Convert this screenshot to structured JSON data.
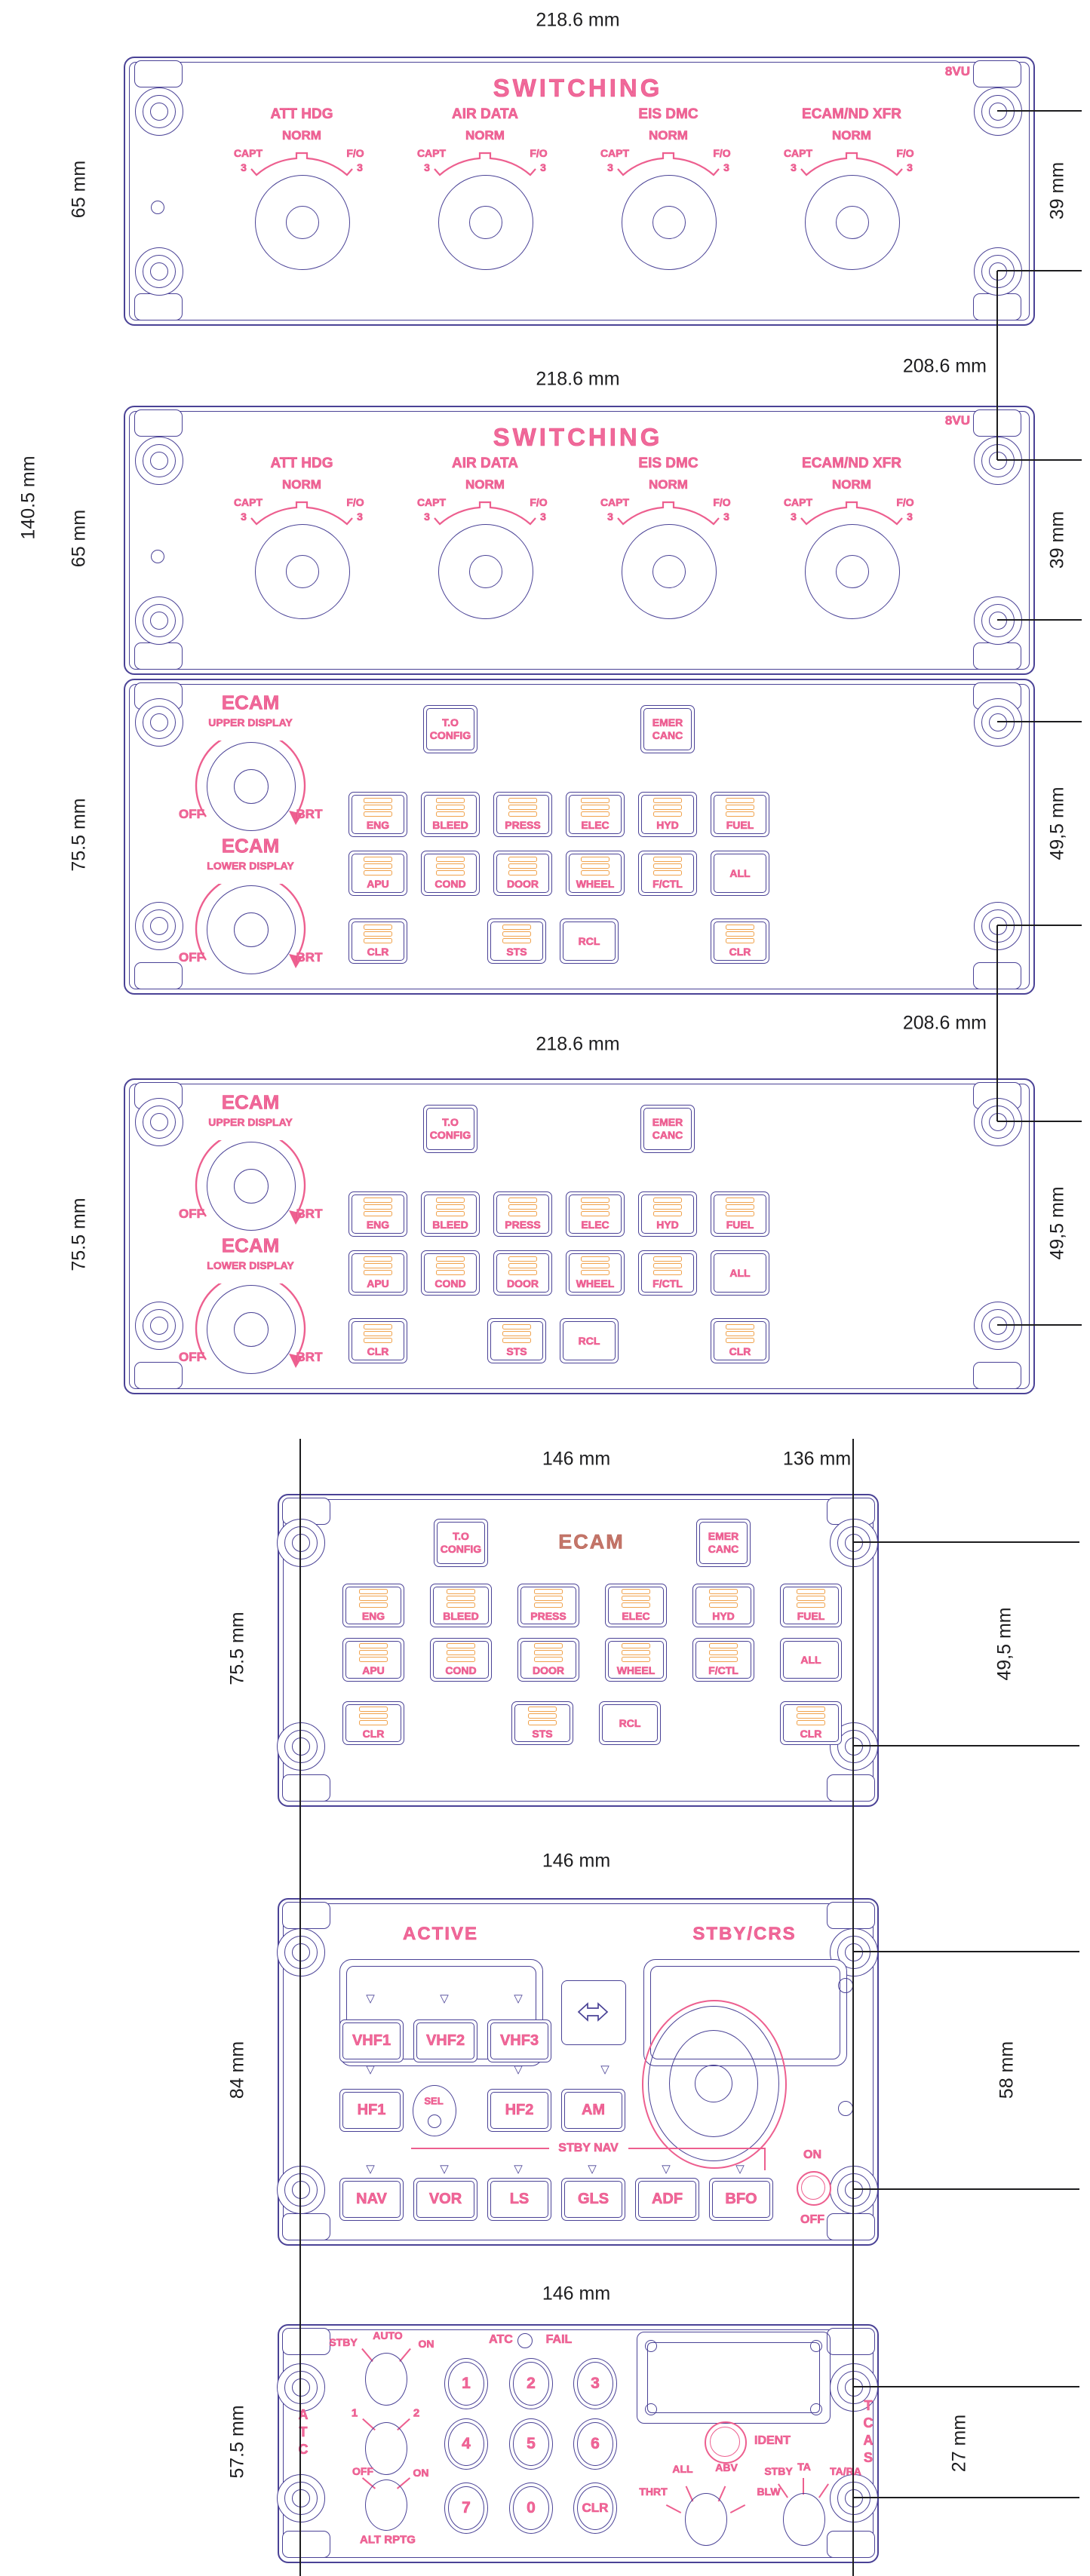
{
  "colors": {
    "line": "#4a4296",
    "pink": "#ed5f8f",
    "orange": "#f0a24c",
    "salmon": "#c4766a",
    "ink": "#1d1d1f"
  },
  "icons": {
    "triangle": "▽",
    "transfer": "double-arrow",
    "lit_bars": "three-bars"
  },
  "dims": {
    "d218": "218.6 mm",
    "d208": "208.6 mm",
    "d65": "65 mm",
    "d39": "39 mm",
    "d140": "140.5 mm",
    "d75": "75.5 mm",
    "d49": "49,5 mm",
    "d146": "146 mm",
    "d136": "136 mm",
    "d84": "84 mm",
    "d58": "58 mm",
    "d575": "57.5 mm",
    "d27": "27 mm"
  },
  "switching": {
    "panel_id": "8VU",
    "title": "SWITCHING",
    "knobs": [
      {
        "name": "ATT HDG",
        "norm": "NORM",
        "capt": "CAPT",
        "fo": "F/O",
        "n3": "3"
      },
      {
        "name": "AIR DATA",
        "norm": "NORM",
        "capt": "CAPT",
        "fo": "F/O",
        "n3": "3"
      },
      {
        "name": "EIS DMC",
        "norm": "NORM",
        "capt": "CAPT",
        "fo": "F/O",
        "n3": "3"
      },
      {
        "name": "ECAM/ND XFR",
        "norm": "NORM",
        "capt": "CAPT",
        "fo": "F/O",
        "n3": "3"
      }
    ]
  },
  "ecp": {
    "ecam": "ECAM",
    "upper": "UPPER DISPLAY",
    "lower": "LOWER DISPLAY",
    "off": "OFF",
    "brt": "BRT",
    "to1": "T.O",
    "to2": "CONFIG",
    "emer1": "EMER",
    "emer2": "CANC",
    "row1": [
      "ENG",
      "BLEED",
      "PRESS",
      "ELEC",
      "HYD",
      "FUEL"
    ],
    "row2": [
      "APU",
      "COND",
      "DOOR",
      "WHEEL",
      "F/CTL",
      "ALL"
    ],
    "row3": [
      "CLR",
      "STS",
      "RCL",
      "CLR"
    ]
  },
  "rmp": {
    "active": "ACTIVE",
    "stbycrs": "STBY/CRS",
    "vhf": [
      "VHF1",
      "VHF2",
      "VHF3"
    ],
    "sel": "SEL",
    "hf": [
      "HF1",
      "HF2",
      "AM"
    ],
    "stbynav": "STBY NAV",
    "nav": [
      "NAV",
      "VOR",
      "LS",
      "GLS",
      "ADF",
      "BFO"
    ],
    "on": "ON",
    "off": "OFF"
  },
  "atc": {
    "left": "ATC",
    "right": "TCAS",
    "mode": [
      "STBY",
      "AUTO",
      "ON"
    ],
    "atc": "ATC",
    "fail": "FAIL",
    "sys": [
      "1",
      "2"
    ],
    "alt": [
      "OFF",
      "ON"
    ],
    "altrptg": "ALT RPTG",
    "ident": "IDENT",
    "keys": [
      "1",
      "2",
      "3",
      "4",
      "5",
      "6",
      "7",
      "0",
      "CLR"
    ],
    "tcasmode": [
      "THRT",
      "ALL",
      "ABV",
      "BLW"
    ],
    "ta": [
      "STBY",
      "TA",
      "TA/RA"
    ]
  }
}
